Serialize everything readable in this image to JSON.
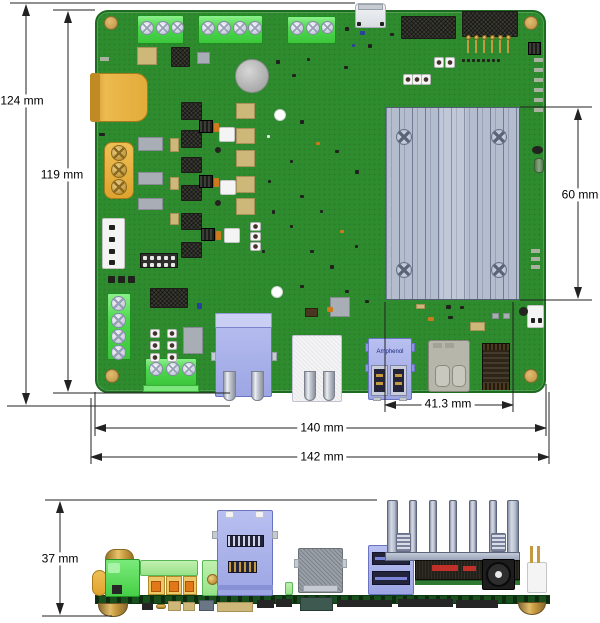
{
  "dims": {
    "overall_height": "124 mm",
    "pcb_height": "119 mm",
    "module_height": "60 mm",
    "module_width": "41.3 mm",
    "pcb_width": "140 mm",
    "overall_width": "142 mm",
    "side_overall_height": "37 mm"
  },
  "labels": {
    "usb_brand": "Amphenol"
  },
  "colors": {
    "background": "#ffffff",
    "pcb_green": "#2e8b2e",
    "terminal_green": "#4cd94c",
    "connector_blue": "#a6aee8",
    "heatsink_gray": "#b4bdce",
    "gold": "#c79a3f",
    "dimension_line": "#222222"
  }
}
